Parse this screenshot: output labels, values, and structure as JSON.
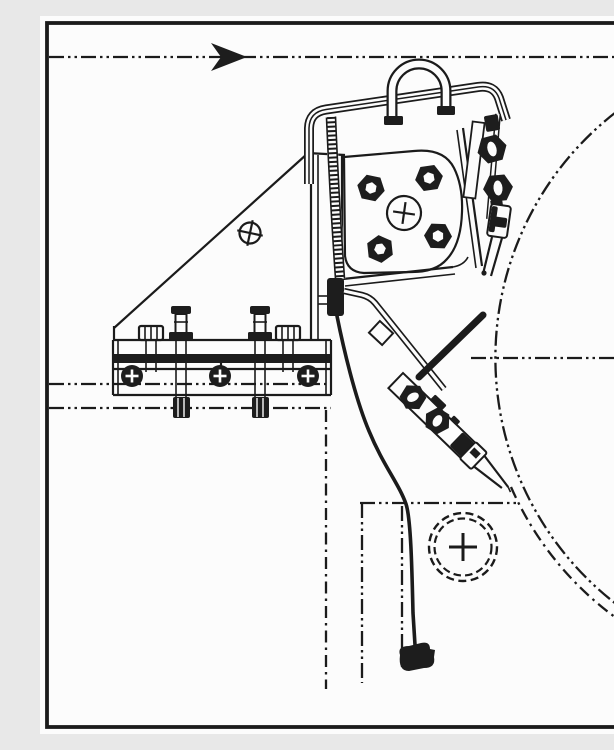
{
  "figure": {
    "kind": "technical-line-drawing",
    "title": "Engineering drawing: wall-mounted bracket, U-bolt strap and turnbuckle tensioner beside phantom vessel outline",
    "paper_color": "#fcfcfc",
    "ink_color": "#1b1b1b",
    "line_styles": {
      "visible": "solid",
      "phantom_centerline": "long dash, two dots",
      "hidden_hole_circle": "dashed double circle"
    },
    "symbols": {
      "direction_arrow": "solid dart arrowhead pointing right on top phantom centerline",
      "center_marks": "circle-with-cross target on gusset and flange; plus-cross in dashed hole circle"
    },
    "components": [
      {
        "id": "border-frame",
        "label": "drawing sheet border"
      },
      {
        "id": "top-centerline",
        "label": "horizontal phantom centerline with flow arrow"
      },
      {
        "id": "gusset-plate",
        "label": "triangular gusset plate with center-mark"
      },
      {
        "id": "base-plate",
        "label": "bolted base plate with studs, nuts and three spot-faced holes"
      },
      {
        "id": "strap-frame",
        "label": "bent strap bracket with rounded corners"
      },
      {
        "id": "u-bolt",
        "label": "U-bolt clamped over strap"
      },
      {
        "id": "flange",
        "label": "flange plate with four hex bolts and central center-mark"
      },
      {
        "id": "link-stack",
        "label": "right-hand clamp linkage with hex fasteners and clevis fork"
      },
      {
        "id": "pivot-lever",
        "label": "pivot bracket with bent lever arm and collar"
      },
      {
        "id": "stop-rod",
        "label": "thick stop rod"
      },
      {
        "id": "turnbuckle",
        "label": "diagonal turnbuckle clamp with hex nuts and fork end"
      },
      {
        "id": "cable",
        "label": "hanging cable with hatched upper strap and dark end fitting"
      },
      {
        "id": "vessel-outline",
        "label": "large phantom arc of vessel shell with parallel lower edge"
      },
      {
        "id": "phantom-box",
        "label": "phantom rectangle below with dashed drilled-hole circle"
      }
    ]
  }
}
